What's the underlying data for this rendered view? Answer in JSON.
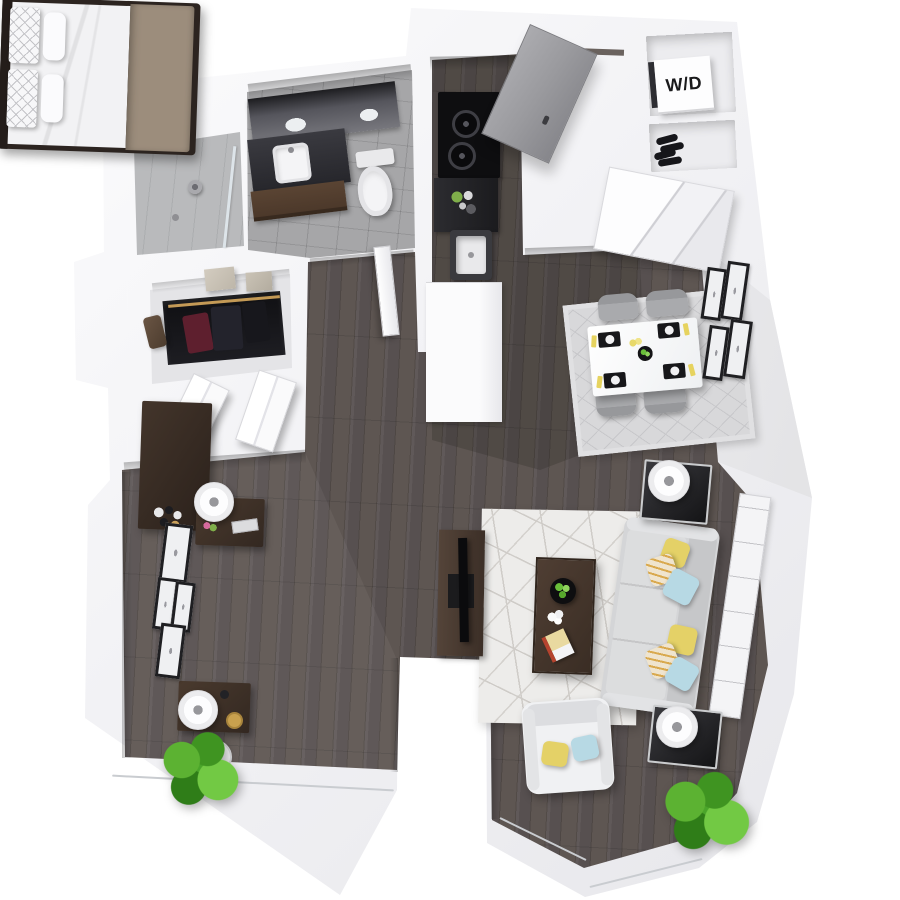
{
  "scene": {
    "title": "3D apartment floor plan - top view",
    "background": "#ffffff"
  },
  "labels": {
    "washer_dryer": "W/D"
  },
  "palette": {
    "wall": "#f4f4f6",
    "wall_shade": "#dcdce0",
    "wood_floor": "#575050",
    "wood_floor_dark": "#46403c",
    "tile_bath": "#a6a6a8",
    "tile_shower": "#b9babc",
    "counter_black": "#141416",
    "cabinet_brown": "#5a4433",
    "furniture_wood": "#332821",
    "sofa_gray": "#d4d5d7",
    "bed_white": "#f2f2f4",
    "blanket_taupe": "#9c8d7c",
    "pillow_yellow": "#e4d167",
    "pillow_blue": "#b7d9e4",
    "pillow_cream": "#efe4ce",
    "rug_living": "#edecea",
    "rug_dining": "#d8d8da",
    "plant_green": "#4aa52a",
    "door_gray": "#9a9a9e",
    "chrome": "#caccce"
  }
}
